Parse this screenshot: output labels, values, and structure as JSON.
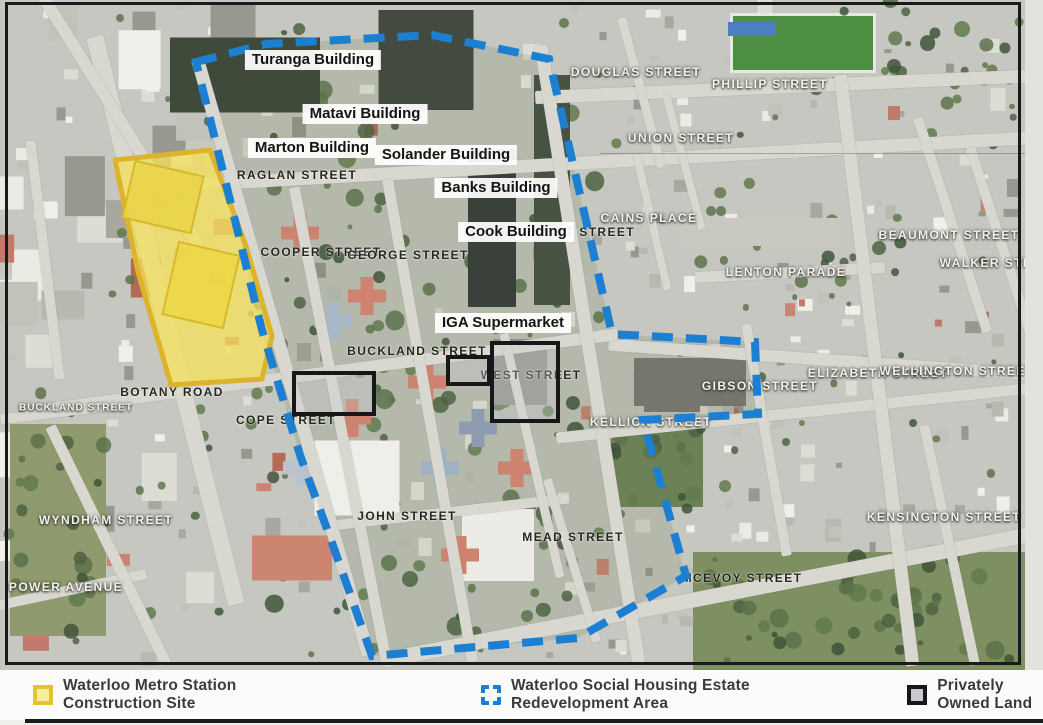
{
  "legend": {
    "items": [
      {
        "id": "metro-site",
        "swatch": "yellow-filled-square",
        "label": "Waterloo Metro Station Construction Site",
        "fill": "#f7ee9c",
        "border": "#e4c231"
      },
      {
        "id": "redevelopment-area",
        "swatch": "blue-dashed-square",
        "label": "Waterloo Social Housing Estate Redevelopment Area",
        "color": "#1d7fd1"
      },
      {
        "id": "private-land",
        "swatch": "black-outline-square",
        "label": "Privately Owned Land",
        "fill": "#c9c9ce",
        "border": "#17171a"
      }
    ]
  },
  "map": {
    "building_labels": [
      {
        "text": "Turanga Building",
        "x": 313,
        "y": 60
      },
      {
        "text": "Matavi Building",
        "x": 365,
        "y": 114
      },
      {
        "text": "Marton Building",
        "x": 312,
        "y": 148
      },
      {
        "text": "Solander Building",
        "x": 446,
        "y": 155
      },
      {
        "text": "Banks Building",
        "x": 496,
        "y": 188
      },
      {
        "text": "Cook Building",
        "x": 516,
        "y": 232
      },
      {
        "text": "IGA Supermarket",
        "x": 503,
        "y": 323
      }
    ],
    "street_labels": [
      {
        "text": "RAGLAN STREET",
        "x": 297,
        "y": 175,
        "rot": -4,
        "tone": "dark"
      },
      {
        "text": "COOPER STREET",
        "x": 321,
        "y": 252,
        "rot": 76,
        "tone": "dark"
      },
      {
        "text": "GEORGE STREET",
        "x": 408,
        "y": 255,
        "rot": 81,
        "tone": "dark"
      },
      {
        "text": "PITT STREET",
        "x": 589,
        "y": 232,
        "rot": 70,
        "tone": "dark"
      },
      {
        "text": "BUCKLAND STREET",
        "x": 417,
        "y": 351,
        "rot": -8,
        "tone": "dark"
      },
      {
        "text": "WEST STREET",
        "x": 531,
        "y": 375,
        "rot": 76,
        "tone": "dark"
      },
      {
        "text": "BOTANY ROAD",
        "x": 172,
        "y": 392,
        "rot": 72,
        "tone": "dark"
      },
      {
        "text": "COPE STREET",
        "x": 286,
        "y": 420,
        "rot": 72,
        "tone": "dark"
      },
      {
        "text": "JOHN STREET",
        "x": 407,
        "y": 516,
        "rot": -6,
        "tone": "dark"
      },
      {
        "text": "MEAD STREET",
        "x": 573,
        "y": 537,
        "rot": 74,
        "tone": "dark"
      },
      {
        "text": "MCEVOY STREET",
        "x": 742,
        "y": 578,
        "rot": -12,
        "tone": "dark"
      },
      {
        "text": "KELLICK STREET",
        "x": 651,
        "y": 422,
        "rot": -3,
        "tone": "light"
      },
      {
        "text": "PHILLIP STREET",
        "x": 770,
        "y": 84,
        "rot": -2,
        "tone": "light"
      },
      {
        "text": "DOUGLAS STREET",
        "x": 636,
        "y": 72,
        "rot": 84,
        "tone": "light"
      },
      {
        "text": "UNION STREET",
        "x": 681,
        "y": 138,
        "rot": 78,
        "tone": "light"
      },
      {
        "text": "CAINS PLACE",
        "x": 649,
        "y": 218,
        "rot": 82,
        "tone": "light"
      },
      {
        "text": "LENTON PARADE",
        "x": 786,
        "y": 272,
        "rot": -3,
        "tone": "light"
      },
      {
        "text": "ELIZABETH STREET",
        "x": 878,
        "y": 373,
        "rot": 86,
        "tone": "light"
      },
      {
        "text": "WELLINGTON STREET",
        "x": 957,
        "y": 371,
        "rot": -7,
        "tone": "light"
      },
      {
        "text": "BEAUMONT STREET",
        "x": 949,
        "y": 235,
        "rot": 73,
        "tone": "light"
      },
      {
        "text": "WALKER STREET",
        "x": 1000,
        "y": 263,
        "rot": 73,
        "tone": "light"
      },
      {
        "text": "GIBSON STREET",
        "x": 760,
        "y": 386,
        "rot": 86,
        "tone": "light"
      },
      {
        "text": "KENSINGTON STREET",
        "x": 944,
        "y": 517,
        "rot": 84,
        "tone": "light"
      },
      {
        "text": "BUCKLAND STREET",
        "x": 76,
        "y": 408,
        "rot": -7,
        "tone": "light",
        "small": true
      },
      {
        "text": "WYNDHAM STREET",
        "x": 106,
        "y": 520,
        "rot": 64,
        "tone": "light"
      },
      {
        "text": "POWER AVENUE",
        "x": 66,
        "y": 587,
        "rot": -11,
        "tone": "light"
      }
    ],
    "overlays": {
      "redevelopment_boundary_points": "196,62 266,44 432,35 549,59 612,334 755,342 758,414 643,420 686,576 578,638 372,656 331,540 300,455 262,330",
      "metro_site_points": "115,160 210,150 246,246 272,336 262,379 171,385 138,272",
      "private_parcels": [
        {
          "x": 292,
          "y": 371,
          "w": 76,
          "h": 37,
          "rot": -4
        },
        {
          "x": 446,
          "y": 355,
          "w": 37,
          "h": 23,
          "rot": -7
        },
        {
          "x": 490,
          "y": 341,
          "w": 62,
          "h": 74,
          "rot": -4
        }
      ]
    }
  },
  "colors": {
    "boundary_blue": "#1d7fd1",
    "site_yellow_fill": "#f2e170",
    "site_yellow_border": "#dcb32a",
    "parcel_black": "#17171a"
  }
}
